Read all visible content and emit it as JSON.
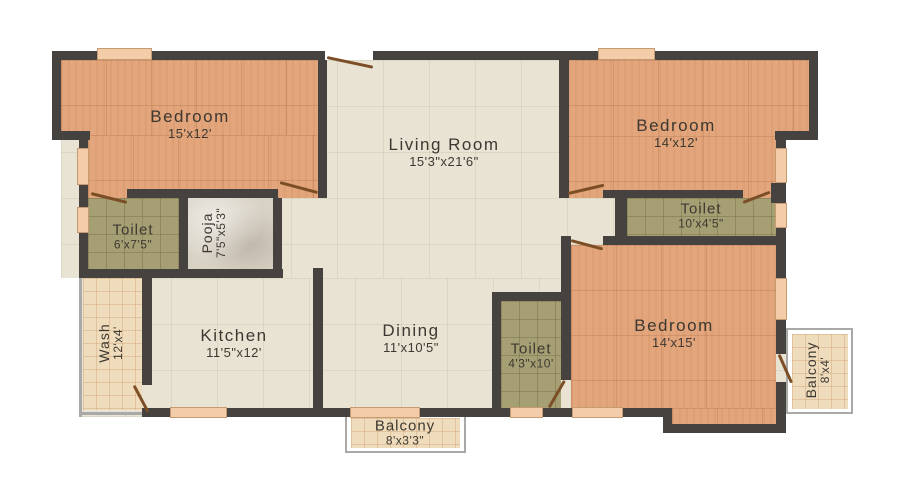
{
  "plan": {
    "type": "apartment-floor-plan",
    "rooms": [
      {
        "name": "Bedroom",
        "dims": "15'x12'"
      },
      {
        "name": "Living Room",
        "dims": "15'3\"x21'6\""
      },
      {
        "name": "Bedroom",
        "dims": "14'x12'"
      },
      {
        "name": "Toilet",
        "dims": "6'x7'5\""
      },
      {
        "name": "Pooja",
        "dims": "7'5\"x5'3\""
      },
      {
        "name": "Toilet",
        "dims": "10'x4'5\""
      },
      {
        "name": "Wash",
        "dims": "12'x4'"
      },
      {
        "name": "Kitchen",
        "dims": "11'5\"x12'"
      },
      {
        "name": "Dining",
        "dims": "11'x10'5\""
      },
      {
        "name": "Toilet",
        "dims": "4'3\"x10'"
      },
      {
        "name": "Bedroom",
        "dims": "14'x15'"
      },
      {
        "name": "Balcony",
        "dims": "8'x4'"
      },
      {
        "name": "Balcony",
        "dims": "8'x3'3\""
      }
    ],
    "colors": {
      "wall": "#454240",
      "bedroom_floor": "#e2a57c",
      "common_floor": "#e9e3d4",
      "toilet_floor": "#a79f74",
      "pooja_floor": "#d8d2c5",
      "balcony_tile": "#eedcbc",
      "window_fill": "#f3cda9",
      "door_swing": "#7c4e26",
      "label_text": "#3d3831",
      "background": "#ffffff"
    }
  }
}
